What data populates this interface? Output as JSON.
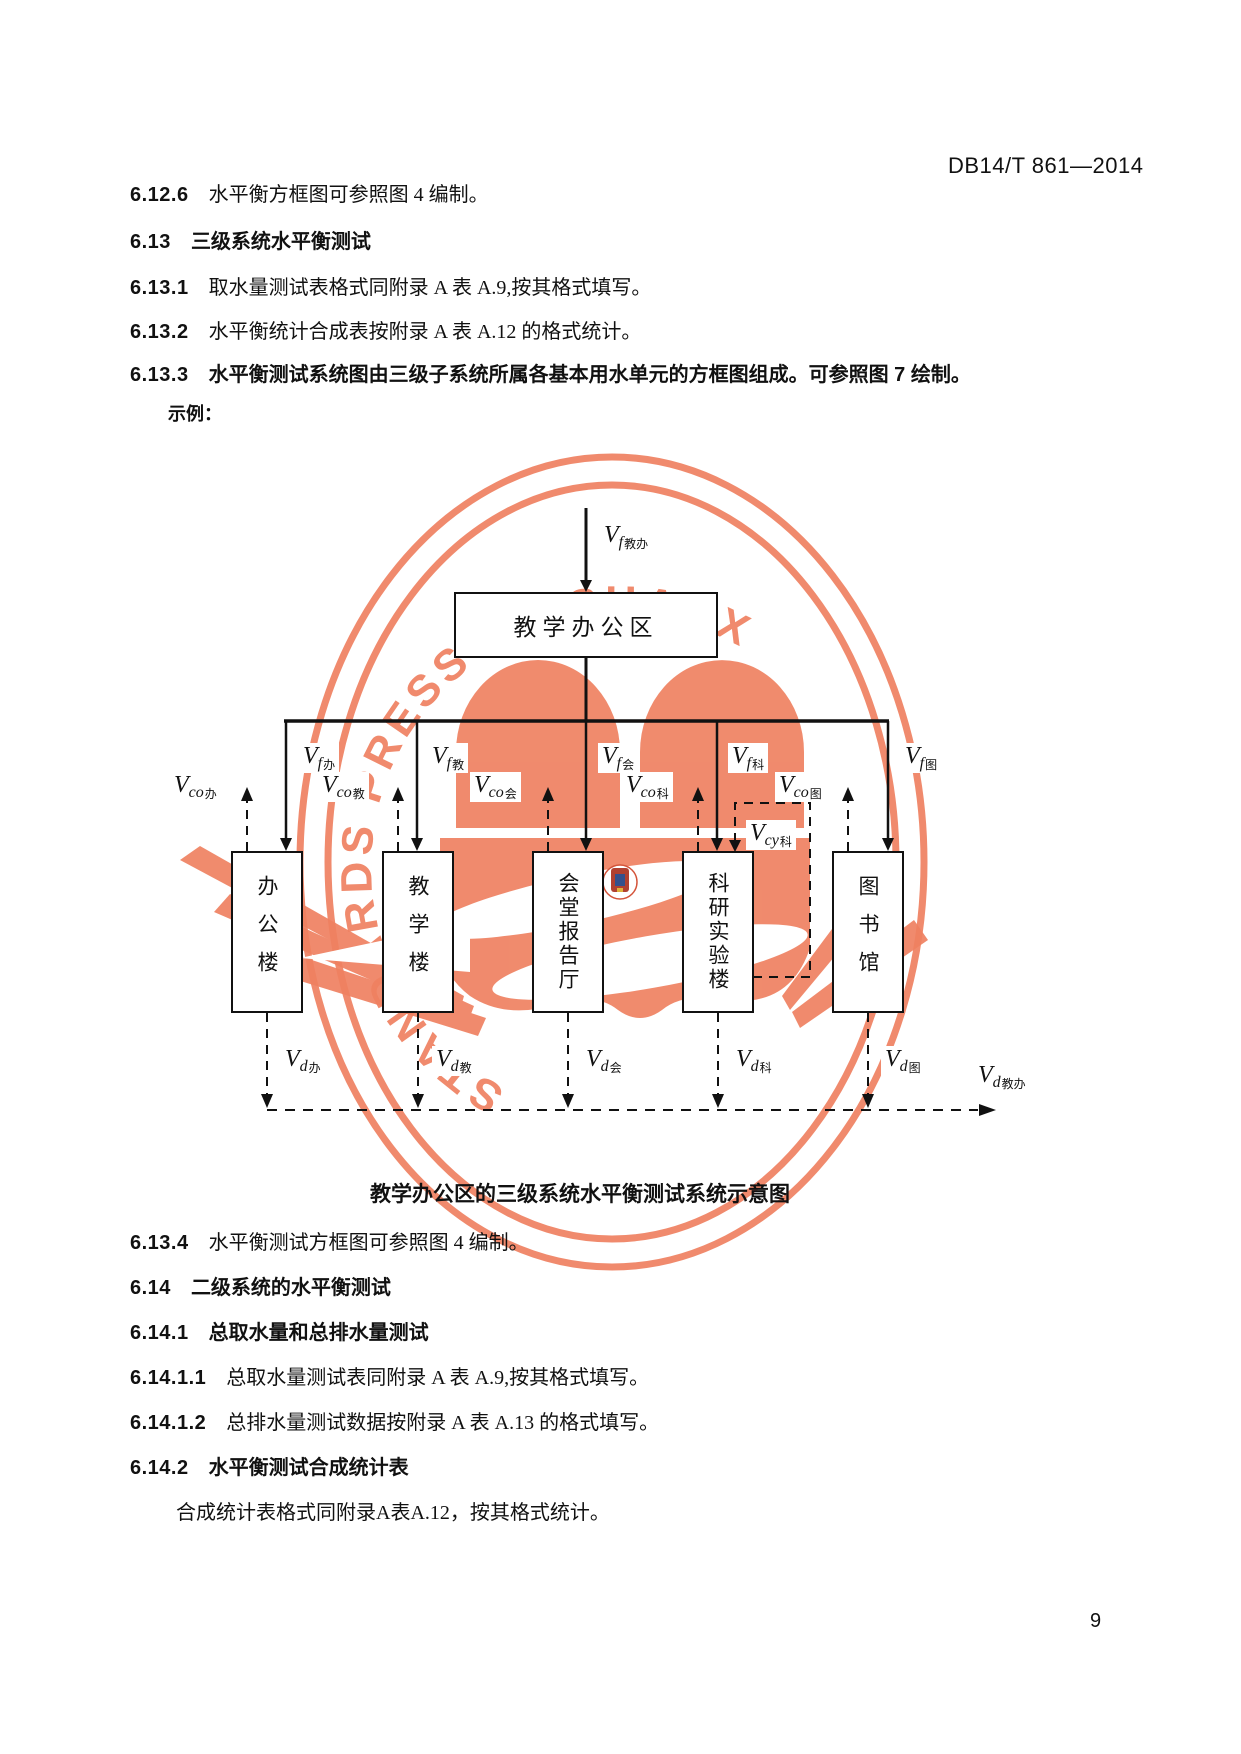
{
  "header": {
    "doc_code": "DB14/T 861—2014"
  },
  "page_number": "9",
  "sections_top": [
    {
      "num": "6.12.6",
      "text": "水平衡方框图可参照图 4 编制。"
    },
    {
      "num": "6.13",
      "text": "三级系统水平衡测试"
    },
    {
      "num": "6.13.1",
      "text": "取水量测试表格式同附录 A 表 A.9,按其格式填写。"
    },
    {
      "num": "6.13.2",
      "text": "水平衡统计合成表按附录 A 表 A.12 的格式统计。"
    },
    {
      "num": "6.13.3",
      "text": "水平衡测试系统图由三级子系统所属各基本用水单元的方框图组成。可参照图 7 绘制。"
    }
  ],
  "example_label": "示例：",
  "diagram": {
    "caption": "教学办公区的三级系统水平衡测试系统示意图",
    "watermark_text": "STANDARDS PRESS OF SHANXI",
    "watermark_color": "#ef8161",
    "line_color": "#111111",
    "top_box": "教学办公区",
    "buildings": [
      {
        "name": "办公楼"
      },
      {
        "name": "教学楼"
      },
      {
        "name": "会堂报告厅"
      },
      {
        "name": "科研实验楼"
      },
      {
        "name": "图书馆"
      }
    ],
    "top_flow": {
      "var": "V",
      "sub": "f",
      "cn": "教办"
    },
    "vf": [
      {
        "var": "V",
        "sub": "f",
        "cn": "办"
      },
      {
        "var": "V",
        "sub": "f",
        "cn": "教"
      },
      {
        "var": "V",
        "sub": "f",
        "cn": "会"
      },
      {
        "var": "V",
        "sub": "f",
        "cn": "科"
      },
      {
        "var": "V",
        "sub": "f",
        "cn": "图"
      }
    ],
    "vco": [
      {
        "var": "V",
        "sub": "co",
        "cn": "办"
      },
      {
        "var": "V",
        "sub": "co",
        "cn": "教"
      },
      {
        "var": "V",
        "sub": "co",
        "cn": "会"
      },
      {
        "var": "V",
        "sub": "co",
        "cn": "科"
      },
      {
        "var": "V",
        "sub": "co",
        "cn": "图"
      }
    ],
    "vcy": {
      "var": "V",
      "sub": "cy",
      "cn": "科"
    },
    "vd": [
      {
        "var": "V",
        "sub": "d",
        "cn": "办"
      },
      {
        "var": "V",
        "sub": "d",
        "cn": "教"
      },
      {
        "var": "V",
        "sub": "d",
        "cn": "会"
      },
      {
        "var": "V",
        "sub": "d",
        "cn": "科"
      },
      {
        "var": "V",
        "sub": "d",
        "cn": "图"
      }
    ],
    "vd_total": {
      "var": "V",
      "sub": "d",
      "cn": "教办"
    }
  },
  "sections_bottom": [
    {
      "num": "6.13.4",
      "text": "水平衡测试方框图可参照图 4 编制。"
    },
    {
      "num": "6.14",
      "text": "二级系统的水平衡测试"
    },
    {
      "num": "6.14.1",
      "text": "总取水量和总排水量测试"
    },
    {
      "num": "6.14.1.1",
      "text": "总取水量测试表同附录 A 表 A.9,按其格式填写。"
    },
    {
      "num": "6.14.1.2",
      "text": "总排水量测试数据按附录 A 表 A.13 的格式填写。"
    },
    {
      "num": "6.14.2",
      "text": "水平衡测试合成统计表"
    }
  ],
  "closing_para": "合成统计表格式同附录A表A.12，按其格式统计。"
}
